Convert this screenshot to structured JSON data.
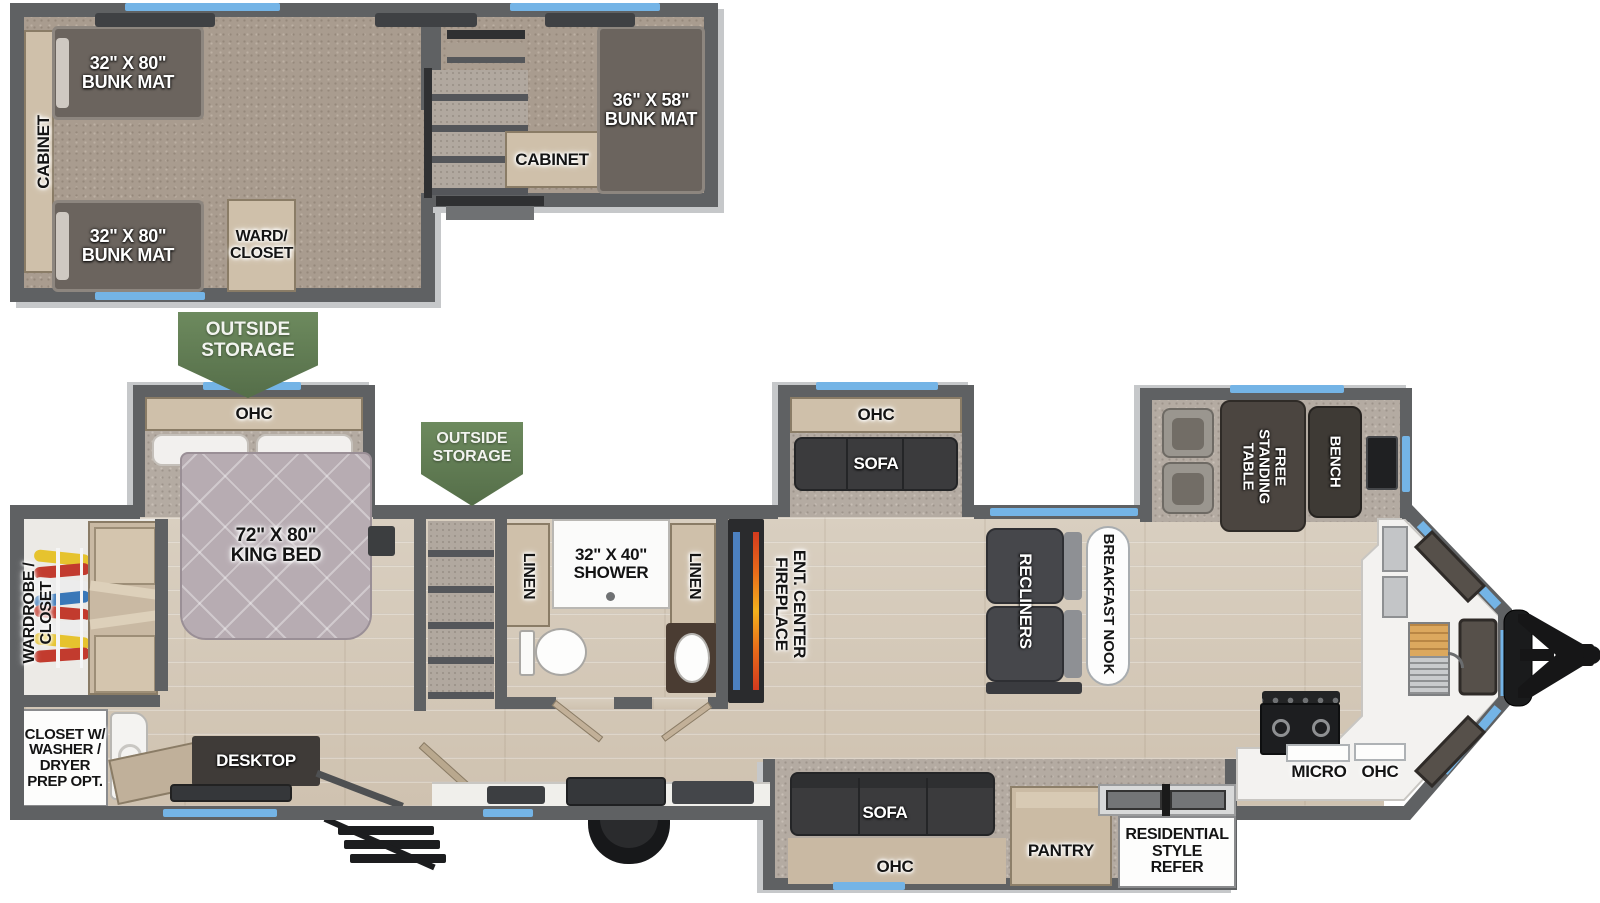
{
  "banners": {
    "outside_storage": "OUTSIDE\nSTORAGE"
  },
  "upper_level": {
    "cabinet_left": "CABINET",
    "bunk_top": "32\" X 80\"\nBUNK MAT",
    "bunk_bottom": "32\" X 80\"\nBUNK MAT",
    "bunk_right": "36\" X 58\"\nBUNK MAT",
    "cabinet_mid": "CABINET",
    "ward_closet": "WARD/\nCLOSET"
  },
  "main_level": {
    "bedroom": {
      "ohc": "OHC",
      "king_bed": "72\" X 80\"\nKING BED",
      "wardrobe_closet": "WARDROBE /\nCLOSET",
      "closet_washer_dryer": "CLOSET W/\nWASHER /\nDRYER\nPREP OPT.",
      "desktop": "DESKTOP"
    },
    "bathroom": {
      "linen_left": "LINEN",
      "shower": "32\" X 40\"\nSHOWER",
      "linen_right": "LINEN"
    },
    "living": {
      "ent_center": "ENT. CENTER\nFIREPLACE",
      "sofa_slide_ohc": "OHC",
      "sofa_slide_sofa": "SOFA",
      "recliners": "RECLINERS",
      "breakfast_nook": "BREAKFAST NOOK"
    },
    "front_bedroom": {
      "table": "FREE\nSTANDING\nTABLE",
      "bench": "BENCH"
    },
    "kitchen": {
      "micro": "MICRO",
      "ohc": "OHC"
    },
    "door_slide": {
      "sofa": "SOFA",
      "ohc": "OHC",
      "pantry": "PANTRY",
      "refer": "RESIDENTIAL\nSTYLE\nREFER"
    }
  },
  "colors": {
    "window_blue": "#74b4e6",
    "banner_green": "#5f7d52",
    "wall_gray": "#5f6163",
    "fireplace_flame": "#e8601c",
    "tv_strip_blue": "#4c80bf"
  }
}
